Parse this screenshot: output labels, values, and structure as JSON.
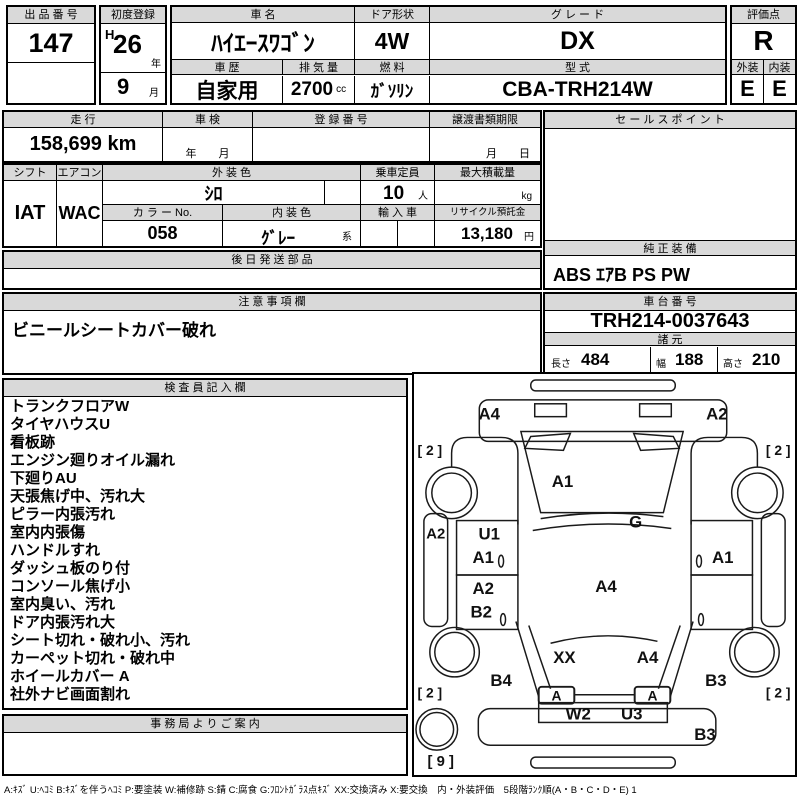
{
  "header": {
    "lot": {
      "label": "出 品 番 号",
      "value": "147"
    },
    "first_registration": {
      "label": "初度登録",
      "era": "H",
      "year": "26",
      "year_unit": "年",
      "month": "9",
      "month_unit": "月"
    },
    "car_name": {
      "label": "車  名",
      "value": "ﾊｲｴｰｽﾜｺﾞﾝ"
    },
    "door_shape": {
      "label": "ドア形状",
      "value": "4W"
    },
    "grade": {
      "label": "グ レ ー ド",
      "value": "DX"
    },
    "score": {
      "label": "評価点",
      "value": "R"
    },
    "history": {
      "label": "車 歴",
      "value": "自家用"
    },
    "displacement": {
      "label": "排 気 量",
      "value": "2700",
      "unit": "cc"
    },
    "fuel": {
      "label": "燃 料",
      "value": "ｶﾞｿﾘﾝ"
    },
    "model_code": {
      "label": "型 式",
      "value": "CBA-TRH214W"
    },
    "exterior_grade": {
      "label": "外装",
      "value": "E"
    },
    "interior_grade": {
      "label": "内装",
      "value": "E"
    }
  },
  "registration": {
    "mileage": {
      "label": "走 行",
      "value": "158,699 km"
    },
    "inspection": {
      "label": "車 検",
      "value": "年　　月"
    },
    "reg_number": {
      "label": "登 録 番 号",
      "value": ""
    },
    "transfer_deadline": {
      "label": "譲渡書類期限",
      "value": "月　　日"
    }
  },
  "specs": {
    "shift": {
      "label": "シフト",
      "value": "IAT"
    },
    "aircon": {
      "label": "エアコン",
      "value": "WAC"
    },
    "exterior_color": {
      "label": "外 装 色",
      "value": "ｼﾛ"
    },
    "capacity": {
      "label": "乗車定員",
      "value": "10",
      "unit": "人"
    },
    "max_load": {
      "label": "最大積載量",
      "value": "",
      "unit": "kg"
    },
    "color_no": {
      "label": "カ ラ ー No.",
      "value": "058"
    },
    "interior_color": {
      "label": "内 装 色",
      "value": "ｸﾞﾚｰ",
      "suffix": "系"
    },
    "imported": {
      "label": "輸 入 車",
      "value": ""
    },
    "recycle_deposit": {
      "label": "リサイクル預託金",
      "value": "13,180",
      "unit": "円"
    }
  },
  "later_shipping_parts": {
    "label": "後 日 発 送 部 品",
    "value": ""
  },
  "sales_point": {
    "label": "セ ー ル ス ポ イ ン ト",
    "value": ""
  },
  "factory_equipment": {
    "label": "純 正 装 備",
    "value": "ABS ｴｱB PS PW"
  },
  "notes": {
    "label": "注 意 事 項 欄",
    "value": "ビニールシートカバー破れ"
  },
  "chassis": {
    "label": "車 台 番 号",
    "value": "TRH214-0037643"
  },
  "dimensions": {
    "label": "諸 元",
    "length_label": "長さ",
    "length": "484",
    "width_label": "幅",
    "width": "188",
    "height_label": "高さ",
    "height": "210"
  },
  "inspector": {
    "label": "検 査 員 記 入 欄",
    "lines": [
      "トランクフロアW",
      "タイヤハウスU",
      "看板跡",
      "エンジン廻りオイル漏れ",
      "下廻りAU",
      "天張焦げ中、汚れ大",
      "ピラー内張汚れ",
      "室内内張傷",
      "ハンドルすれ",
      "ダッシュ板のり付",
      "コンソール焦げ小",
      "室内臭い、汚れ",
      "ドア内張汚れ大",
      "シート切れ・破れ小、汚れ",
      "カーペット切れ・破れ中",
      "ホイールカバー A",
      "社外ナビ画面割れ"
    ]
  },
  "office_notice": {
    "label": "事 務 局 よ り ご 案 内",
    "value": ""
  },
  "legend": "A:ｷｽﾞ U:ﾍｺﾐ B:ｷｽﾞを伴うﾍｺﾐ P:要塗装 W:補修跡 S:錆 C:腐食 G:ﾌﾛﾝﾄｶﾞﾗｽ点ｷｽﾞ XX:交換済み X:要交換　内・外装評価　5段階ﾗﾝｸ順(A・B・C・D・E) 1",
  "diagram": {
    "labels": [
      "A4",
      "A2",
      "[ 2 ]",
      "[ 2 ]",
      "A1",
      "G",
      "A2",
      "U1",
      "A1",
      "A1",
      "A2",
      "B2",
      "A4",
      "XX",
      "A4",
      "B4",
      "B3",
      "[ 2 ]",
      "[ 2 ]",
      "A",
      "A",
      "W2",
      "U3",
      "B3",
      "[ 9 ]"
    ]
  }
}
